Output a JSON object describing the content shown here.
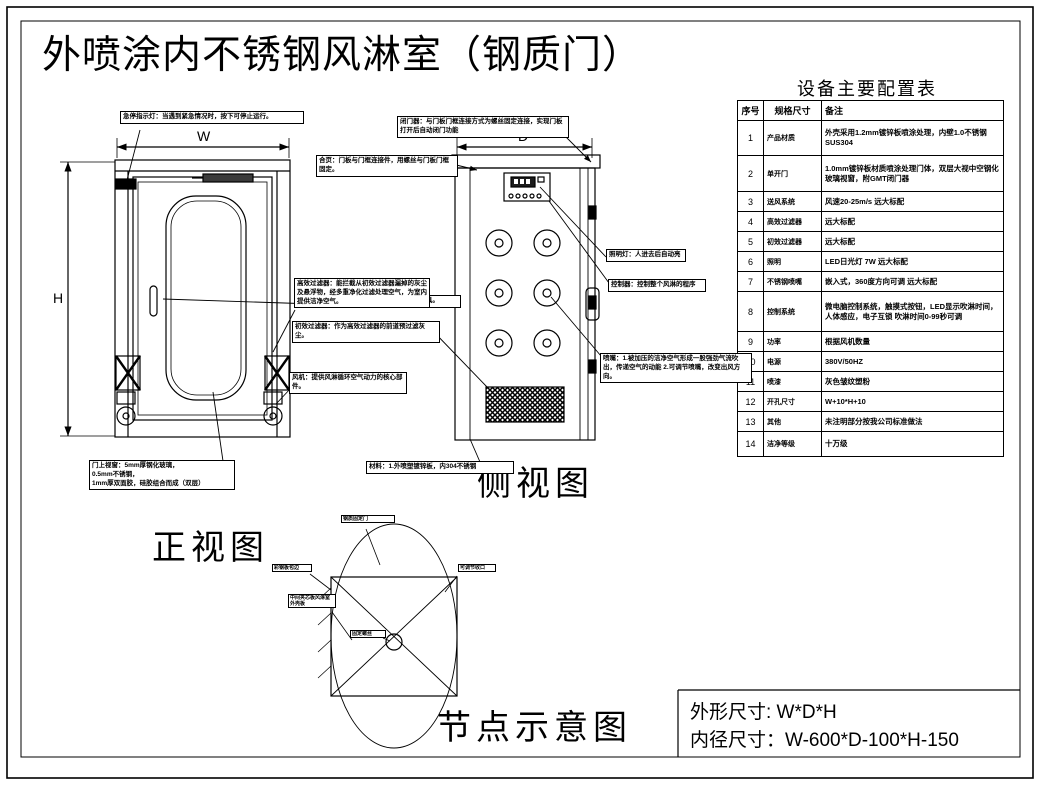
{
  "title": "外喷涂内不锈钢风淋室（钢质门）",
  "views": {
    "front_label": "正视图",
    "side_label": "侧视图",
    "node_label": "节点示意图"
  },
  "dims": {
    "w": "W",
    "h": "H",
    "d": "D"
  },
  "config_table": {
    "title": "设备主要配置表",
    "headers": [
      "序号",
      "规格尺寸",
      "备注"
    ],
    "rows": [
      {
        "no": "1",
        "item": "产品材质",
        "note": "外壳采用1.2mm镀锌板喷涂处理，内壁1.0不锈钢SUS304"
      },
      {
        "no": "2",
        "item": "单开门",
        "note": "1.0mm镀锌板材质喷涂处理门体，双层大视中空钢化玻璃视窗，附GMT闭门器"
      },
      {
        "no": "3",
        "item": "送风系统",
        "note": "风速20-25m/s 远大标配"
      },
      {
        "no": "4",
        "item": "高效过滤器",
        "note": "远大标配"
      },
      {
        "no": "5",
        "item": "初效过滤器",
        "note": "远大标配"
      },
      {
        "no": "6",
        "item": "照明",
        "note": "LED日光灯 7W 远大标配"
      },
      {
        "no": "7",
        "item": "不锈钢喷嘴",
        "note": "嵌入式，360度方向可调 远大标配"
      },
      {
        "no": "8",
        "item": "控制系统",
        "note": "微电脑控制系统，触摸式按钮，LED显示吹淋时间，人体感应，电子互锁 吹淋时间0-99秒可调"
      },
      {
        "no": "9",
        "item": "功率",
        "note": "根据风机数量"
      },
      {
        "no": "10",
        "item": "电源",
        "note": "380V/50HZ"
      },
      {
        "no": "11",
        "item": "喷漆",
        "note": "灰色皱纹塑粉"
      },
      {
        "no": "12",
        "item": "开孔尺寸",
        "note": "W+10*H+10"
      },
      {
        "no": "13",
        "item": "其他",
        "note": "未注明部分按我公司标准做法"
      },
      {
        "no": "14",
        "item": "洁净等级",
        "note": "十万级"
      }
    ]
  },
  "callouts": {
    "estop": "急停指示灯：当遇到紧急情况时，按下可停止运行。",
    "closer": "闭门器：与门板门框连接方式为螺丝固定连接，实现门板打开后自动闭门功能",
    "hinge": "合页：门板与门框连接件，用螺丝与门板门框固定。",
    "handle": "门拉手，用来开、关门的工具。",
    "hepa": "高效过滤器：能拦截从初效过滤器漏掉的灰尘及悬浮物，经多重净化过滤处理空气，为室内提供洁净空气。",
    "prefilter": "初效过滤器：作为高效过滤器的前道预过滤灰尘。",
    "fan": "风机：提供风淋循环空气动力的核心部件。",
    "window": "门上视窗：5mm厚钢化玻璃，\n0.5mm不锈钢，\n1mm厚双面胶，硅胶组合而成（双层）",
    "material": "材料：1.外喷塑镀锌板，内304不锈钢",
    "light": "照明灯：人进去后自动亮",
    "controller": "控制器：控制整个风淋的程序",
    "nozzle": "喷嘴：1.被加压的洁净空气形成一股强劲气流吹出，传递空气的动能 2.可调节喷嘴，改变出风方向。"
  },
  "node_labels": {
    "top": "钢质固定门",
    "left1": "彩钢板包边",
    "left2": "中间夹芯板风淋室外壳板",
    "right": "可调节收口",
    "center": "固定螺丝"
  },
  "footer": {
    "line1": "外形尺寸: W*D*H",
    "line2": "内径尺寸：W-600*D-100*H-150"
  }
}
